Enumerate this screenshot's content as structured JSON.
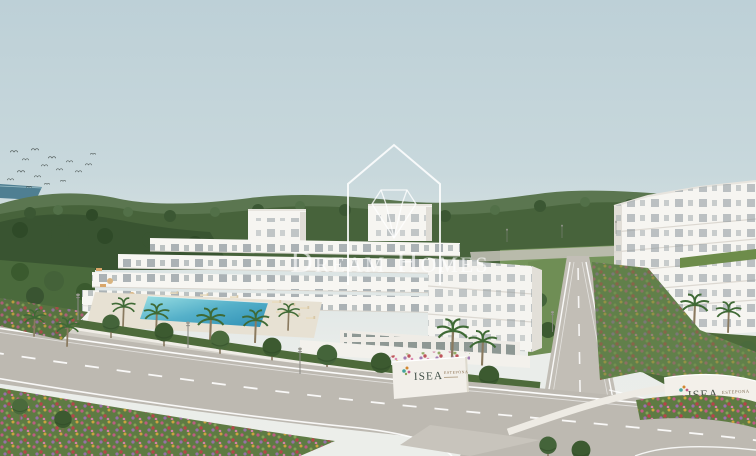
{
  "scene": {
    "description": "Aerial architectural render of a white terraced apartment development on green hills by the sea, with swimming pool, palm-lined curving roads and flower verges",
    "watermark": {
      "icon": "house-outline-with-diamond-gem",
      "text": "Dream Homes"
    },
    "signs": {
      "main_entrance": {
        "brand": "ISEA",
        "subtitle": "ESTEPONA"
      },
      "phase_wall": {
        "brand": "ISEA",
        "subtitle": "ESTEPONA",
        "phase": "FASE I"
      }
    },
    "palette": {
      "sky": "#c8d8dc",
      "sea": "#4f7f92",
      "hills": "#46603a",
      "building_white": "#f6f5f1",
      "green_roof": "#6d8c4a",
      "pool": "#49aac6",
      "road": "#bdb9b1",
      "verge_green": "#5e7b43",
      "flowers": [
        "#c25a86",
        "#b8434a",
        "#d2a53f",
        "#9a6fae"
      ],
      "watermark": "#ffffff"
    }
  }
}
